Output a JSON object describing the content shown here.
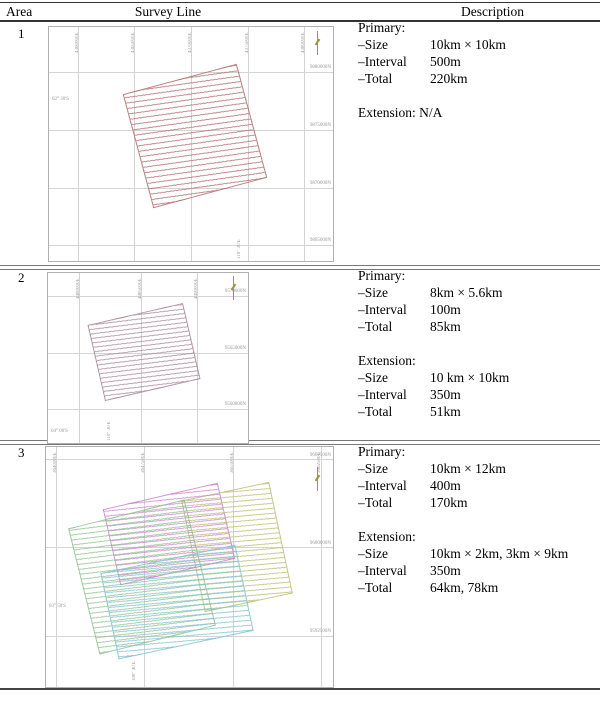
{
  "header": {
    "col_area": "Area",
    "col_survey": "Survey Line",
    "col_description": "Description"
  },
  "rows": [
    {
      "area": "1",
      "desc": {
        "primary_heading": "Primary:",
        "p_size_label": "–Size",
        "p_size": "10km × 10km",
        "p_int_label": "–Interval",
        "p_int": "500m",
        "p_tot_label": "–Total",
        "p_tot": "220km",
        "extension_heading": "Extension: N/A"
      }
    },
    {
      "area": "2",
      "desc": {
        "primary_heading": "Primary:",
        "p_size_label": "–Size",
        "p_size": "8km × 5.6km",
        "p_int_label": "–Interval",
        "p_int": "100m",
        "p_tot_label": "–Total",
        "p_tot": "85km",
        "extension_heading": "Extension:",
        "e_size_label": "–Size",
        "e_size": "10 km × 10km",
        "e_int_label": "–Interval",
        "e_int": "350m",
        "e_tot_label": "–Total",
        "e_tot": "51km"
      }
    },
    {
      "area": "3",
      "desc": {
        "primary_heading": "Primary:",
        "p_size_label": "–Size",
        "p_size": "10km × 12km",
        "p_int_label": "–Interval",
        "p_int": "400m",
        "p_tot_label": "–Total",
        "p_tot": "170km",
        "extension_heading": "Extension:",
        "e_size_label": "–Size",
        "e_size": "10km × 2km, 3km × 9km",
        "e_int_label": "–Interval",
        "e_int": "350m",
        "e_tot_label": "–Total",
        "e_tot": "64km, 78km"
      }
    }
  ],
  "maps": [
    {
      "x_ticks": [
        "4360000E",
        "4365000E",
        "4370000E",
        "4375000E",
        "4380000E"
      ],
      "y_ticks": [
        "9880000N",
        "9875000N",
        "9870000N",
        "9865000N"
      ],
      "lat": "02° 30'S",
      "lon": "118° 30'E"
    },
    {
      "x_ticks": [
        "4480000E",
        "4485000E",
        "4490000E"
      ],
      "y_ticks": [
        "9570000N",
        "9565000N",
        "9560000N"
      ],
      "lat": "04° 00'S",
      "lon": "110° 30'E"
    },
    {
      "x_ticks": [
        "3640000E",
        "3647500E",
        "3655000E",
        "3662500E"
      ],
      "y_ticks": [
        "9607500N",
        "9600000N",
        "9592500N"
      ],
      "lat": "03° 50'S",
      "lon": "108° 40'E"
    }
  ],
  "colors": {
    "survey_area1": "#b06e6e",
    "survey_area2": "#a58296",
    "survey_area3_green": "#8cbe8c",
    "survey_area3_magenta": "#c682c6",
    "survey_area3_cyan": "#82c3d2",
    "survey_area3_yellow": "#bec47d",
    "north_arrow": "#9a9a3c",
    "grid_line": "#d4d4d4",
    "map_border": "#b0b0b0",
    "table_rule": "#333333"
  }
}
